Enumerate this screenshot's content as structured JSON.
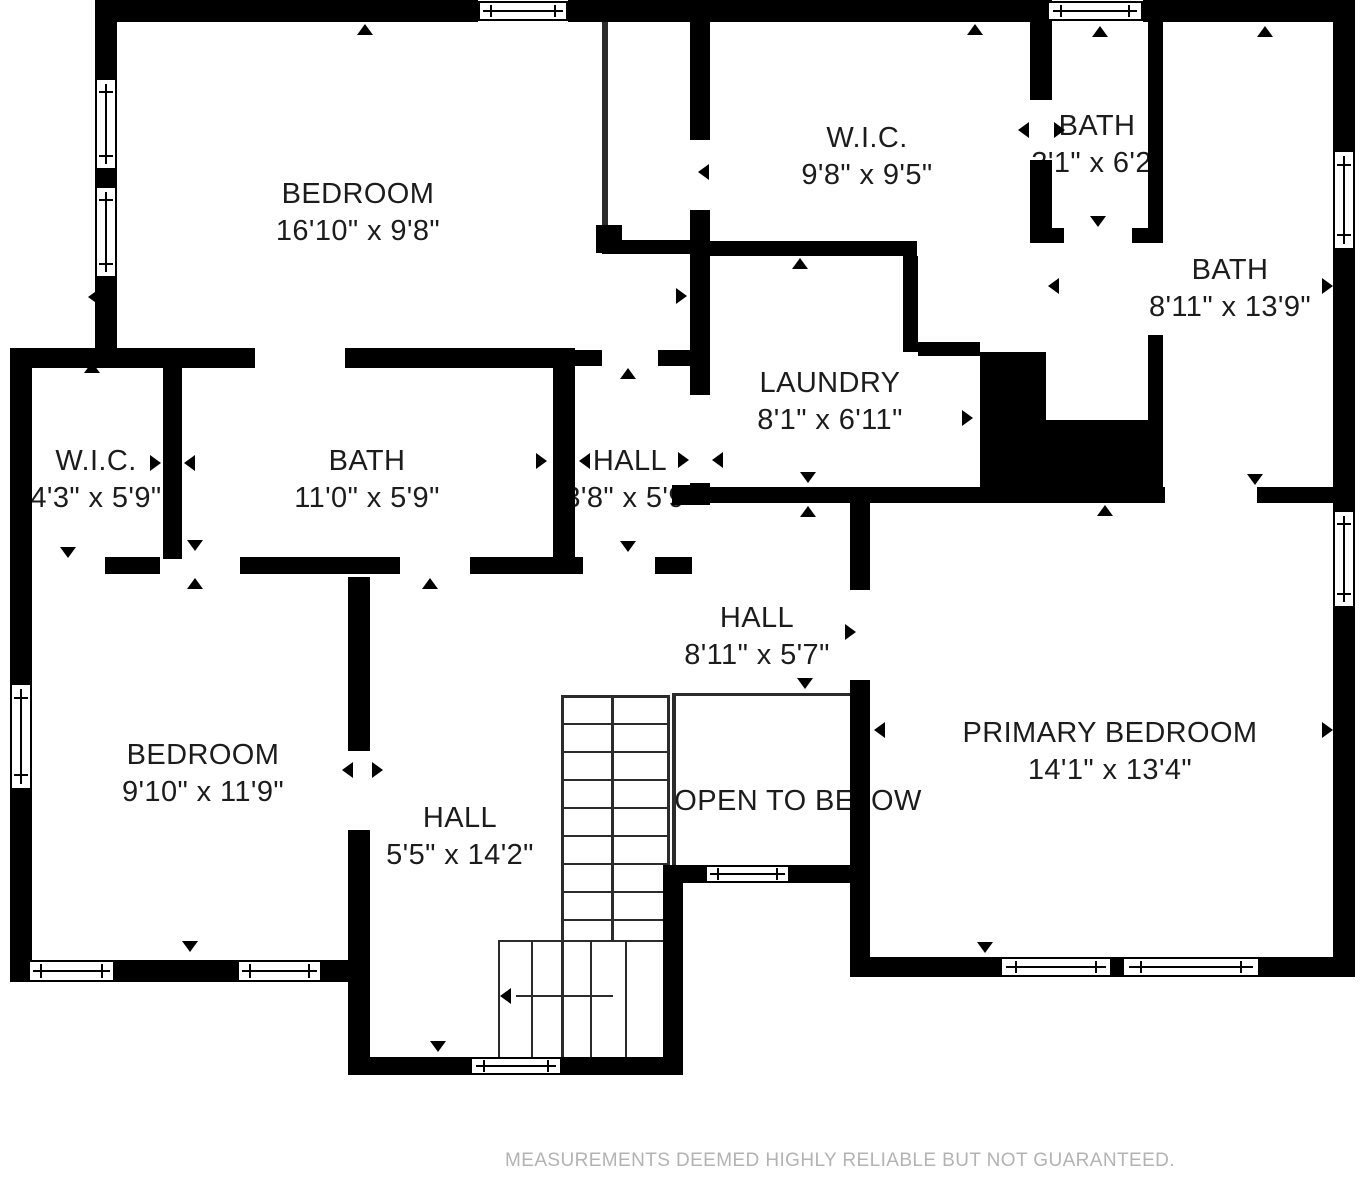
{
  "rooms": {
    "bedroom_top": {
      "name": "BEDROOM",
      "dims": "16'10\" x 9'8\""
    },
    "wic_large": {
      "name": "W.I.C.",
      "dims": "9'8\" x 9'5\""
    },
    "bath_small": {
      "name": "BATH",
      "dims": "3'1\" x 6'2\""
    },
    "bath_large": {
      "name": "BATH",
      "dims": "8'11\" x 13'9\""
    },
    "laundry": {
      "name": "LAUNDRY",
      "dims": "8'1\" x 6'11\""
    },
    "wic_small": {
      "name": "W.I.C.",
      "dims": "4'3\" x 5'9\""
    },
    "bath_middle": {
      "name": "BATH",
      "dims": "11'0\" x 5'9\""
    },
    "hall_small": {
      "name": "HALL",
      "dims": "3'8\" x 5'9\""
    },
    "hall_upper": {
      "name": "HALL",
      "dims": "8'11\" x 5'7\""
    },
    "bedroom_left": {
      "name": "BEDROOM",
      "dims": "9'10\" x 11'9\""
    },
    "hall_stairs": {
      "name": "HALL",
      "dims": "5'5\" x 14'2\""
    },
    "open_to_below": {
      "label": "OPEN TO BELOW"
    },
    "primary_bedroom": {
      "name": "PRIMARY BEDROOM",
      "dims": "14'1\" x 13'4\""
    }
  },
  "footer": {
    "disclaimer": "MEASUREMENTS DEEMED HIGHLY RELIABLE BUT NOT GUARANTEED."
  }
}
